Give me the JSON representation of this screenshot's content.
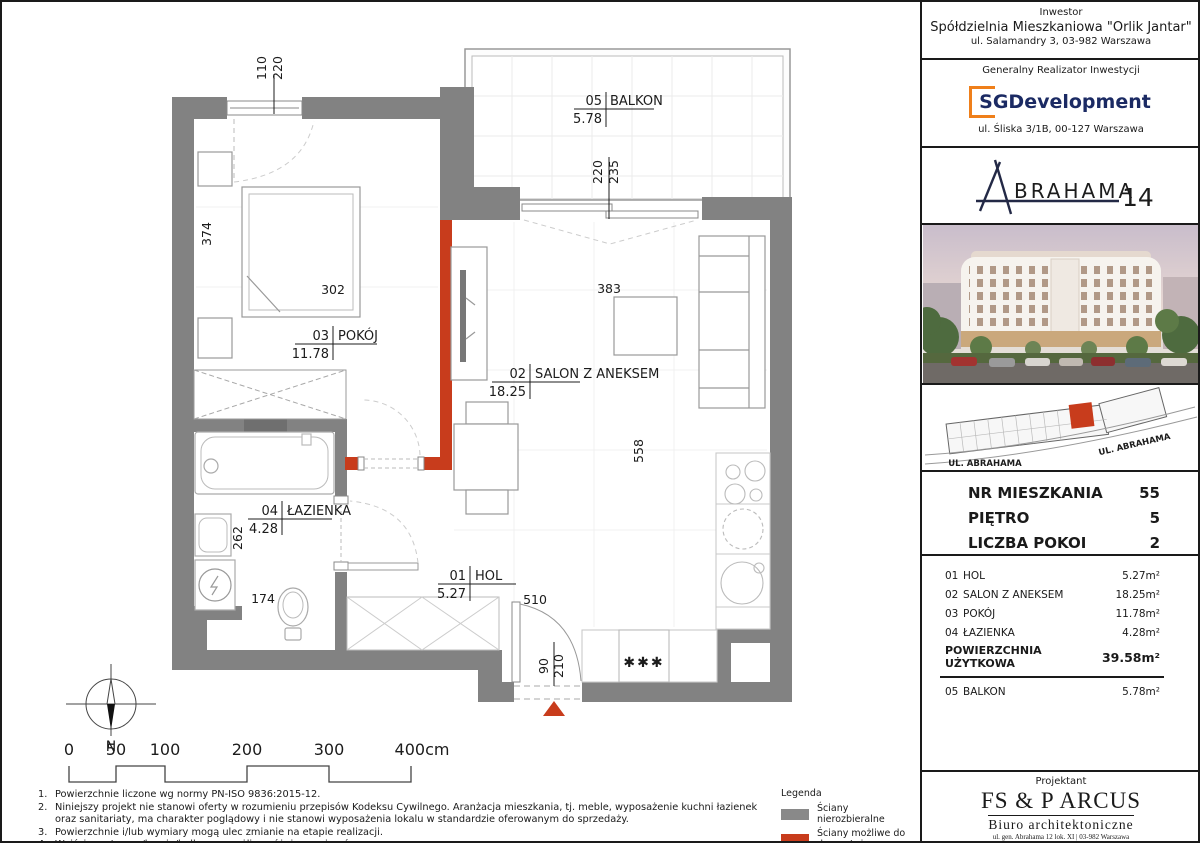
{
  "plan": {
    "rooms": {
      "balkon": {
        "id": "05",
        "name": "BALKON",
        "area": "5.78"
      },
      "pokoj": {
        "id": "03",
        "name": "POKÓJ",
        "area": "11.78"
      },
      "salon": {
        "id": "02",
        "name": "SALON Z ANEKSEM",
        "area": "18.25"
      },
      "lazienka": {
        "id": "04",
        "name": "ŁAZIENKA",
        "area": "4.28"
      },
      "hol": {
        "id": "01",
        "name": "HOL",
        "area": "5.27"
      }
    },
    "dims": {
      "window_w": "110",
      "window_h": "220",
      "balcony_door_w": "220",
      "balcony_door_h": "235",
      "bed_len": "374",
      "bed_w": "302",
      "salon_w": "383",
      "salon_l": "558",
      "bath_l": "262",
      "bath_w": "174",
      "hol_len": "510",
      "entry_door_w": "90",
      "entry_door_h": "210",
      "freezer_symbol": "✱✱✱"
    },
    "compass_n": "N",
    "scale_ticks": [
      "0",
      "50",
      "100",
      "200",
      "300",
      "400cm"
    ],
    "wall_colors": {
      "fixed": "#828282",
      "removable": "#c83c1c"
    }
  },
  "footnotes": [
    {
      "num": "1.",
      "text": "Powierzchnie liczone wg normy PN-ISO 9836:2015-12."
    },
    {
      "num": "2.",
      "text": "Niniejszy projekt nie stanowi oferty w rozumieniu przepisów Kodeksu Cywilnego. Aranżacja mieszkania, tj. meble, wyposażenie  kuchni łazienek oraz sanitariaty, ma charakter poglądowy i nie stanowi wyposażenia lokalu w standardzie oferowanym do sprzedaży."
    },
    {
      "num": "3.",
      "text": "Powierzchnie i/lub wymiary mogą ulec zmianie na etapie realizacji."
    },
    {
      "num": "4.",
      "text": "Wyjście na tarasy/loggie/balkony - możliwa różnica poziomów."
    }
  ],
  "legend": {
    "title": "Legenda",
    "items": [
      {
        "label": "Ściany nierozbieralne",
        "color": "#898989"
      },
      {
        "label": "Ściany możliwe do demontażu",
        "color": "#c83c1c"
      }
    ]
  },
  "sidebar": {
    "investor": {
      "label": "Inwestor",
      "name": "Spółdzielnia Mieszkaniowa \"Orlik Jantar\"",
      "address": "ul. Salamandry 3, 03-982 Warszawa"
    },
    "developer": {
      "label": "Generalny Realizator Inwestycji",
      "logo_text": "SGDevelopment",
      "address": "ul. Śliska 3/1B, 00-127 Warszawa",
      "logo_color": "#1b2a63",
      "logo_accent": "#ef7f1a"
    },
    "brand": {
      "name_rest": "BRAHAMA",
      "number": "14"
    },
    "siteplan": {
      "street_label_left": "UL. ABRAHAMA",
      "street_label_right": "UL. ABRAHAMA",
      "unit_color": "#c83c1c"
    },
    "unit_info": {
      "rows": [
        {
          "label": "NR MIESZKANIA",
          "value": "55"
        },
        {
          "label": "PIĘTRO",
          "value": "5"
        },
        {
          "label": "LICZBA POKOI",
          "value": "2"
        }
      ]
    },
    "areas": {
      "rows": [
        {
          "no": "01",
          "name": "HOL",
          "value": "5.27m²"
        },
        {
          "no": "02",
          "name": "SALON Z ANEKSEM",
          "value": "18.25m²"
        },
        {
          "no": "03",
          "name": "POKÓJ",
          "value": "11.78m²"
        },
        {
          "no": "04",
          "name": "ŁAZIENKA",
          "value": "4.28m²"
        }
      ],
      "total_label_line1": "POWIERZCHNIA",
      "total_label_line2": "UŻYTKOWA",
      "total_value": "39.58m²",
      "balcony_row": {
        "no": "05",
        "name": "BALKON",
        "value": "5.78m²"
      }
    },
    "designer": {
      "label": "Projektant",
      "name": "FS & P ARCUS",
      "subname": "Biuro architektoniczne",
      "address_line1": "ul. gen. Abrahama 12 lok. XI | 03-982 Warszawa",
      "address_line2": "www.fsparcus.com.pl | fsparcus@fsparcus.com.pl"
    }
  }
}
